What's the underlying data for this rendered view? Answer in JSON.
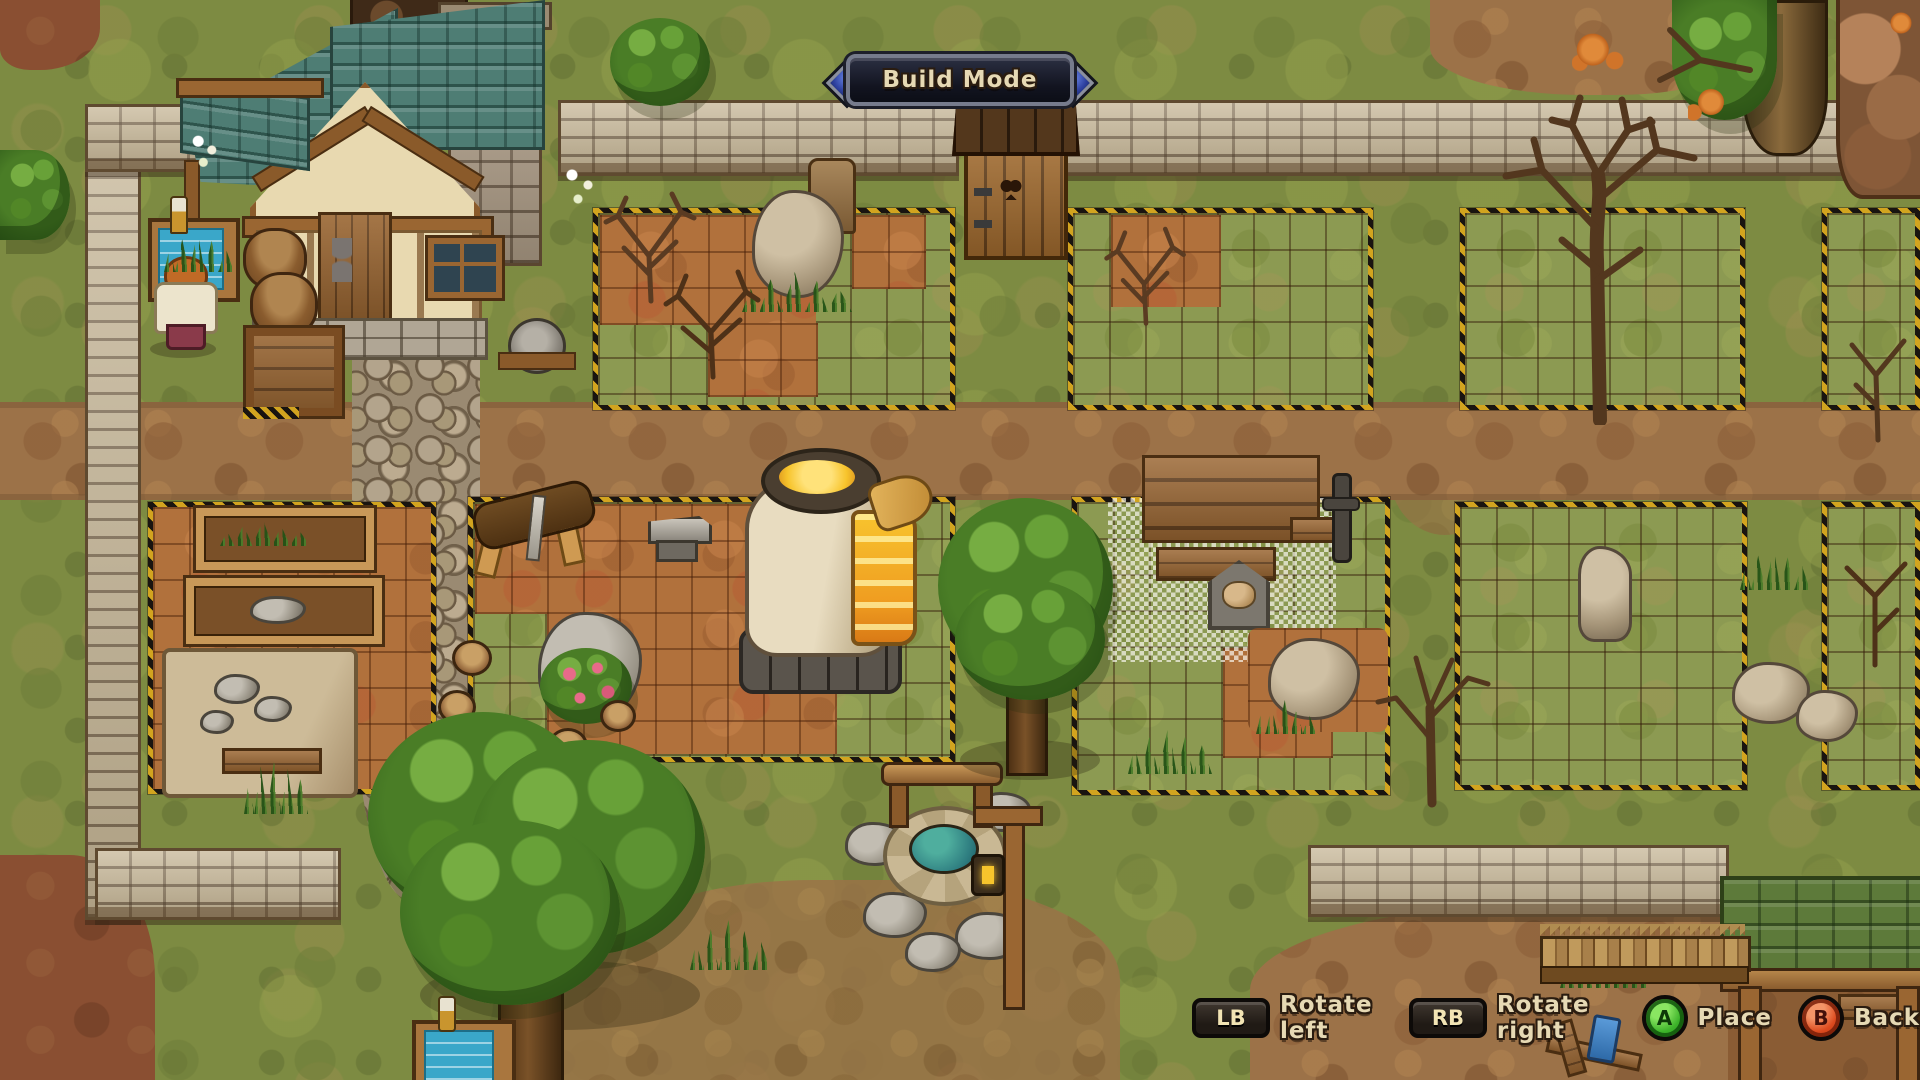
{
  "hud": {
    "banner": {
      "label": "Build Mode",
      "gem_color": "#3c55c2",
      "frame_color": "#767b8c"
    },
    "controls": [
      {
        "key": "LB",
        "label": "Rotate left",
        "type": "shoulder-button"
      },
      {
        "key": "RB",
        "label": "Rotate right",
        "type": "shoulder-button"
      },
      {
        "key": "A",
        "label": "Place",
        "type": "face-button",
        "button_color": "#3db32a"
      },
      {
        "key": "B",
        "label": "Back",
        "type": "face-button",
        "button_color": "#dd4a1e"
      }
    ]
  },
  "scene": {
    "mode": "build-mode-placement",
    "palette": {
      "grass": "#7d8b42",
      "soil_tile": "#b1713c",
      "grid_line": "#3a2410",
      "hazard_yellow": "#d2a41f",
      "hazard_black": "#191410",
      "wall_stone": "#c6b696",
      "roof_teal": "#4e7d74",
      "fire_glow": "#f7c42c"
    },
    "objects": [
      "house",
      "outhouse",
      "furnace",
      "anvil",
      "sawing-horse",
      "workbench-ghost",
      "well",
      "blueprint-table",
      "player-character",
      "planter-boxes",
      "covered-stone-pile",
      "trees",
      "dead-trees",
      "stone-walls",
      "build-plots",
      "shed",
      "picket-fence"
    ]
  }
}
